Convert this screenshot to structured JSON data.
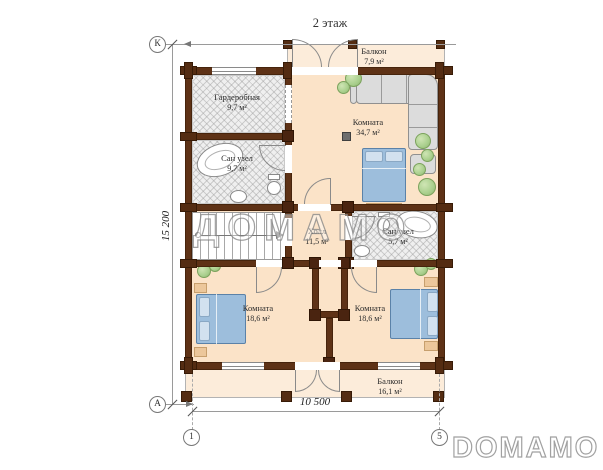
{
  "title": "2 этаж",
  "watermark": "ДОМАМО",
  "brand_logo": "DOMAMO",
  "axes": {
    "top_left": "К",
    "bottom_left": "А",
    "bottom_first": "1",
    "bottom_last": "5"
  },
  "dimensions": {
    "horizontal": "10 500",
    "vertical": "15 200"
  },
  "rooms": [
    {
      "id": "balcony-top",
      "name": "Балкон",
      "area": "7,9 м²"
    },
    {
      "id": "wardrobe",
      "name": "Гардеробная",
      "area": "9,7 м²"
    },
    {
      "id": "master-room",
      "name": "Комната",
      "area": "34,7 м²"
    },
    {
      "id": "bathroom-left",
      "name": "Сан узел",
      "area": "9,7 м²"
    },
    {
      "id": "hall",
      "name": "Холл",
      "area": "11,5 м²"
    },
    {
      "id": "bathroom-right",
      "name": "Сан узел",
      "area": "5,7 м²"
    },
    {
      "id": "bedroom-left",
      "name": "Комната",
      "area": "18,6 м²"
    },
    {
      "id": "bedroom-right",
      "name": "Комната",
      "area": "18,6 м²"
    },
    {
      "id": "balcony-bottom",
      "name": "Балкон",
      "area": "16,1 м²"
    }
  ],
  "colors": {
    "wall": "#5e3216",
    "floor": "#fbe3c8",
    "balcony_floor": "#fcecda",
    "bed": "#9dbedc",
    "plant": "#a9cf8d",
    "hatch": "#efefef"
  }
}
